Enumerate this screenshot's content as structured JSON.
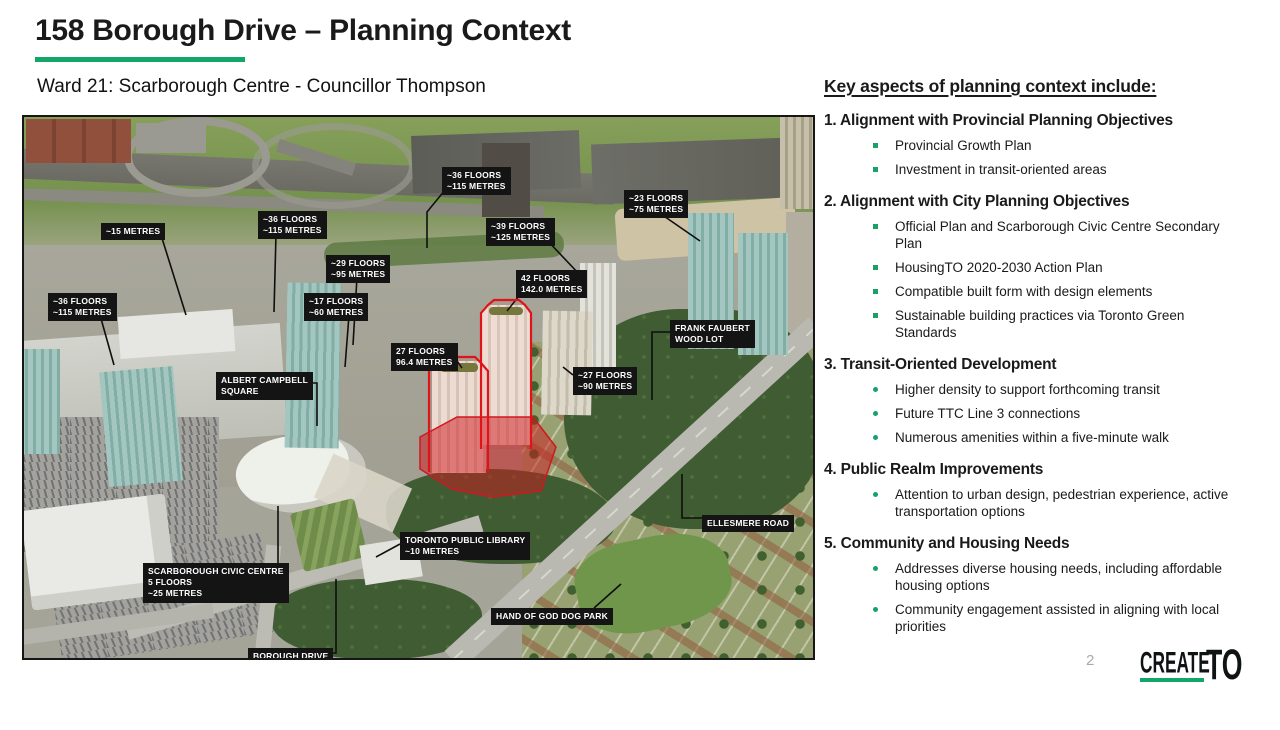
{
  "slide": {
    "title": "158 Borough Drive – Planning Context",
    "subtitle": "Ward 21: Scarborough Centre - Councillor Thompson",
    "page_number": "2",
    "accent_green": "#12a768",
    "label_bg": "#141414"
  },
  "key_aspects": {
    "heading": "Key aspects of planning context include:",
    "sections": [
      {
        "number": "1.",
        "title": "Alignment with Provincial Planning Objectives",
        "bullet_style": "square",
        "items": [
          "Provincial Growth Plan",
          "Investment in transit-oriented areas"
        ]
      },
      {
        "number": "2.",
        "title": "Alignment with City Planning Objectives",
        "bullet_style": "square",
        "items": [
          "Official Plan and Scarborough Civic Centre Secondary Plan",
          "HousingTO 2020-2030 Action Plan",
          "Compatible built form with design elements",
          "Sustainable building practices via Toronto Green Standards"
        ]
      },
      {
        "number": "3.",
        "title": "Transit-Oriented Development",
        "bullet_style": "dot",
        "items": [
          "Higher density to support forthcoming transit",
          "Future TTC Line 3 connections",
          "Numerous amenities within a five-minute walk"
        ]
      },
      {
        "number": "4.",
        "title": "Public Realm Improvements",
        "bullet_style": "dot",
        "items": [
          "Attention to urban design, pedestrian experience, active transportation options"
        ]
      },
      {
        "number": "5.",
        "title": "Community and Housing Needs",
        "bullet_style": "dot",
        "items": [
          "Addresses diverse housing needs, including affordable housing options",
          "Community engagement assisted in aligning with local priorities"
        ]
      }
    ]
  },
  "map": {
    "labels": [
      {
        "text": "~15 METRES",
        "x": 77,
        "y": 106
      },
      {
        "text": "~36 FLOORS\n~115 METRES",
        "x": 234,
        "y": 94
      },
      {
        "text": "~29 FLOORS\n~95 METRES",
        "x": 302,
        "y": 138
      },
      {
        "text": "~36 FLOORS\n~115 METRES",
        "x": 24,
        "y": 176
      },
      {
        "text": "~17 FLOORS\n~60 METRES",
        "x": 280,
        "y": 176
      },
      {
        "text": "~36 FLOORS\n~115 METRES",
        "x": 418,
        "y": 50
      },
      {
        "text": "~23 FLOORS\n~75 METRES",
        "x": 600,
        "y": 73
      },
      {
        "text": "~39 FLOORS\n~125 METRES",
        "x": 462,
        "y": 101
      },
      {
        "text": "42 FLOORS\n142.0 METRES",
        "x": 492,
        "y": 153
      },
      {
        "text": "ALBERT CAMPBELL\nSQUARE",
        "x": 192,
        "y": 255
      },
      {
        "text": "27 FLOORS\n96.4 METRES",
        "x": 367,
        "y": 226
      },
      {
        "text": "~27 FLOORS\n~90 METRES",
        "x": 549,
        "y": 250
      },
      {
        "text": "FRANK FAUBERT\nWOOD LOT",
        "x": 646,
        "y": 203
      },
      {
        "text": "SCARBOROUGH CIVIC CENTRE\n5 FLOORS\n~25 METRES",
        "x": 119,
        "y": 446
      },
      {
        "text": "TORONTO PUBLIC LIBRARY\n~10 METRES",
        "x": 376,
        "y": 415
      },
      {
        "text": "ELLESMERE ROAD",
        "x": 678,
        "y": 398
      },
      {
        "text": "HAND OF GOD DOG PARK",
        "x": 467,
        "y": 491
      },
      {
        "text": "BOROUGH DRIVE",
        "x": 224,
        "y": 531
      }
    ]
  },
  "logo": {
    "create": "CREATE",
    "to": "TO"
  }
}
